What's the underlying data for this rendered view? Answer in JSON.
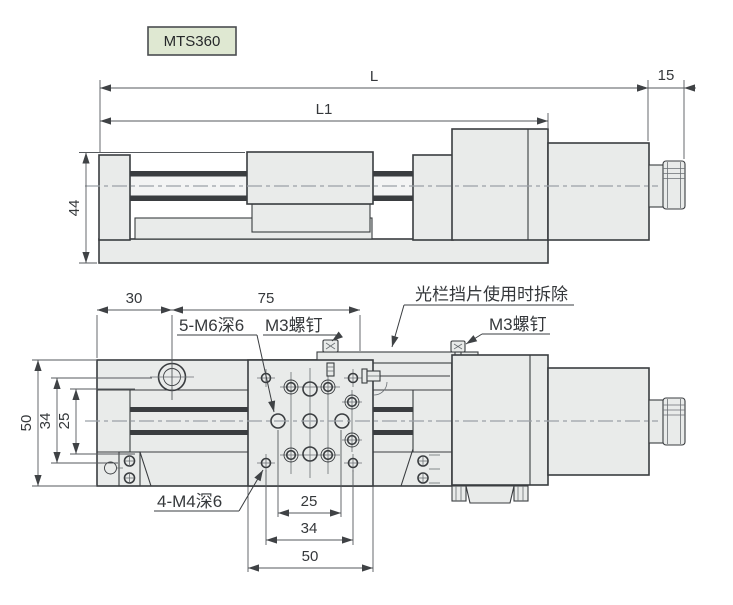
{
  "model_label": "MTS360",
  "side_view": {
    "dims": {
      "length_total": "L",
      "length_body": "L1",
      "height": "44",
      "knob_section": "15"
    }
  },
  "plan_view": {
    "dims": {
      "edge_to_hole": "30",
      "hole_span": "75",
      "left_outer": "50",
      "left_mid": "34",
      "left_inner": "25",
      "bottom_inner": "25",
      "bottom_mid": "34",
      "bottom_outer": "50"
    },
    "annotations": {
      "m6_holes": "5-M6深6",
      "m3_screw_left": "M3螺钉",
      "flag_removal_note": "光栏挡片使用时拆除",
      "m3_screw_right": "M3螺钉",
      "m4_holes": "4-M4深6"
    }
  },
  "colors": {
    "background": "#ffffff",
    "part_fill": "#e9ebea",
    "outline": "#3a3d40",
    "dim_line": "#565a5e",
    "centerline": "#9aa1a6",
    "label_fill": "#dfe8d2",
    "label_border": "#4a4d50"
  }
}
